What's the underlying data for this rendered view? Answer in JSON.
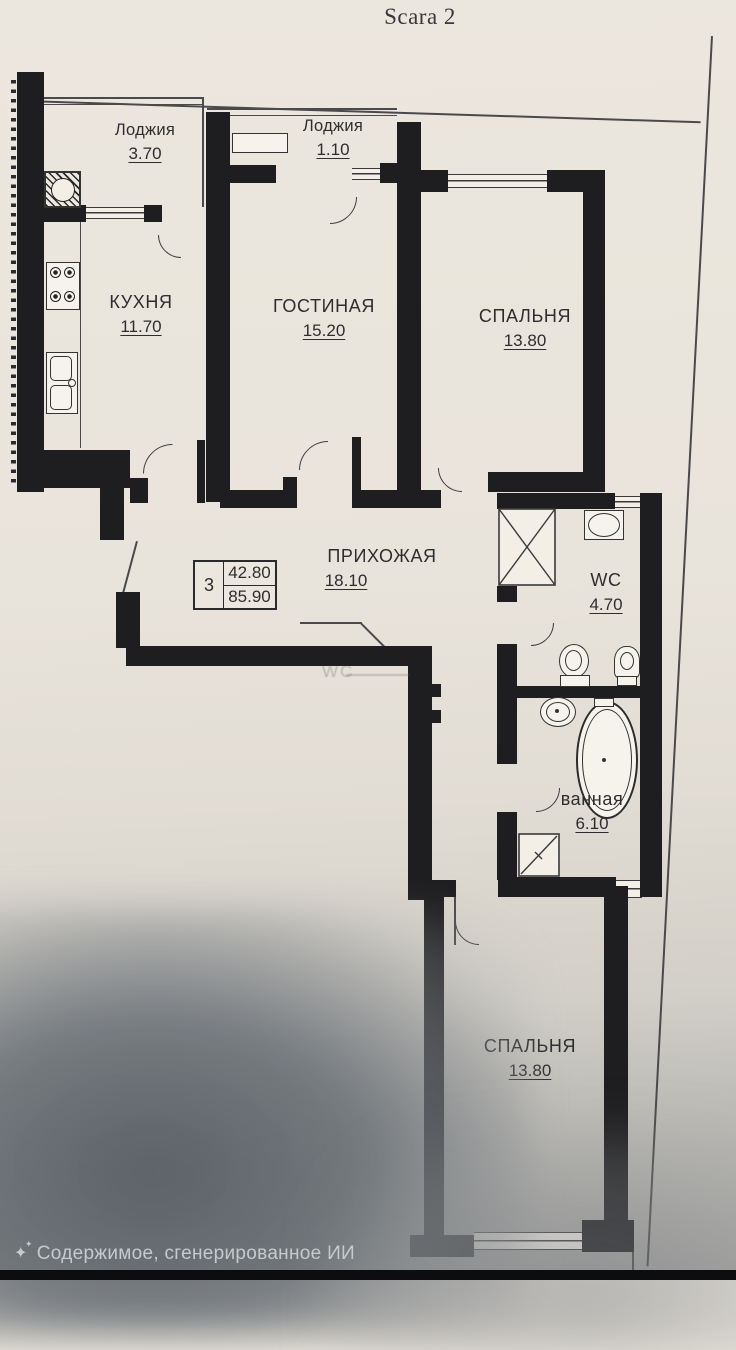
{
  "sheet": {
    "title": "Scara 2"
  },
  "plan": {
    "rooms": [
      {
        "id": "loggia-left",
        "name": "Лоджия",
        "area": "3.70"
      },
      {
        "id": "loggia-top",
        "name": "Лоджия",
        "area": "1.10"
      },
      {
        "id": "kitchen",
        "name": "КУХНЯ",
        "area": "11.70"
      },
      {
        "id": "living-room",
        "name": "ГОСТИНАЯ",
        "area": "15.20"
      },
      {
        "id": "bedroom-top",
        "name": "СПАЛЬНЯ",
        "area": "13.80"
      },
      {
        "id": "hallway",
        "name": "ПРИХОЖАЯ",
        "area": "18.10"
      },
      {
        "id": "wc",
        "name": "WC",
        "area": "4.70"
      },
      {
        "id": "bathroom",
        "name": "ванная",
        "area": "6.10"
      },
      {
        "id": "bedroom-bottom",
        "name": "СПАЛЬНЯ",
        "area": "13.80"
      }
    ],
    "info_box": {
      "rooms_count": "3",
      "living_area": "42.80",
      "total_area": "85.90"
    },
    "ghost_label": "WC"
  },
  "watermark": {
    "icon": "sparkle-icon",
    "text": "Содержимое, сгенерированное ИИ"
  },
  "colors": {
    "wall": "#1e1e20",
    "paper": "#e9e4da",
    "line": "#4a4a4c",
    "shadow": "#6d7277",
    "watermark": "#c6cacd",
    "text": "#2d2d30"
  }
}
